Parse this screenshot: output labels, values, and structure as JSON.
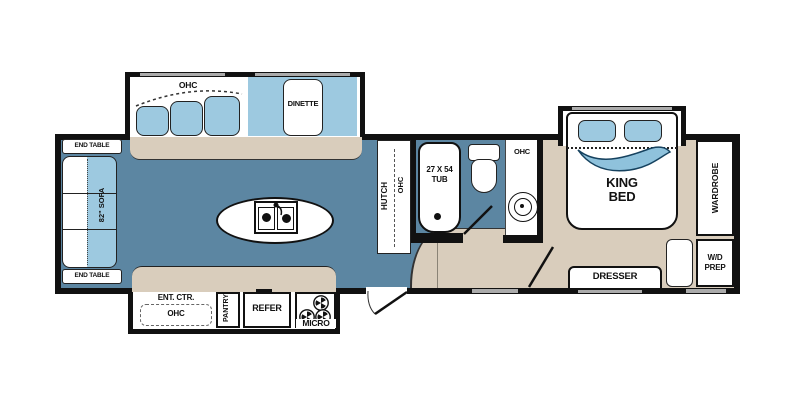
{
  "colors": {
    "floor_blue": "#5C86A2",
    "furniture_blue": "#9DC9E0",
    "floor_tan": "#D9CDBC",
    "wall_black": "#111111",
    "window_gray": "#ABABAB"
  },
  "living_slideout": {
    "ohc": "OHC",
    "dinette": "DINETTE"
  },
  "sofa_area": {
    "end_table_top": "END TABLE",
    "sofa": "82\" SOFA",
    "end_table_bottom": "END TABLE"
  },
  "kitchen": {
    "hutch": "HUTCH",
    "hutch_ohc": "OHC"
  },
  "kitchen_slideout": {
    "ent_ctr": "ENT. CTR.",
    "ohc": "OHC",
    "pantry": "PANTRY",
    "refer": "REFER",
    "micro": "MICRO"
  },
  "bath": {
    "tub_size": "27 X 54",
    "tub": "TUB",
    "ohc": "OHC"
  },
  "bedroom": {
    "bed_l1": "KING",
    "bed_l2": "BED",
    "wardrobe": "WARDROBE",
    "wd_l1": "W/D",
    "wd_l2": "PREP",
    "dresser": "DRESSER"
  }
}
